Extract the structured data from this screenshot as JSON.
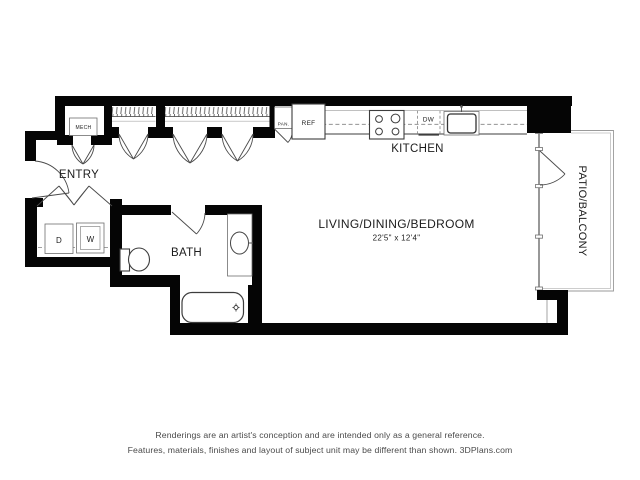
{
  "meta": {
    "title": "studio-apartment-floor-plan",
    "canvas_width": 640,
    "canvas_height": 480
  },
  "colors": {
    "wall": "#050505",
    "line": "#3d3d3d",
    "light_line": "#9a9a9a",
    "text": "#1c1c1c",
    "footer_text": "#4a4a4a",
    "background": "#ffffff"
  },
  "rooms": {
    "entry": {
      "label": "ENTRY"
    },
    "kitchen": {
      "label": "KITCHEN"
    },
    "bath": {
      "label": "BATH"
    },
    "living": {
      "label": "LIVING/DINING/BEDROOM",
      "dimensions": "22'5\" x 12'4\""
    },
    "patio": {
      "label": "PATIO/BALCONY"
    },
    "mech": {
      "label": "MECH"
    }
  },
  "fixtures": {
    "pantry": "PAN.",
    "refrigerator": "REF",
    "dishwasher": "DW",
    "dryer": "D",
    "washer": "W"
  },
  "footer": {
    "line1": "Renderings are an artist's conception and are intended only as a general reference.",
    "line2": "Features, materials, finishes and layout of subject unit may be different than shown. 3DPlans.com"
  }
}
